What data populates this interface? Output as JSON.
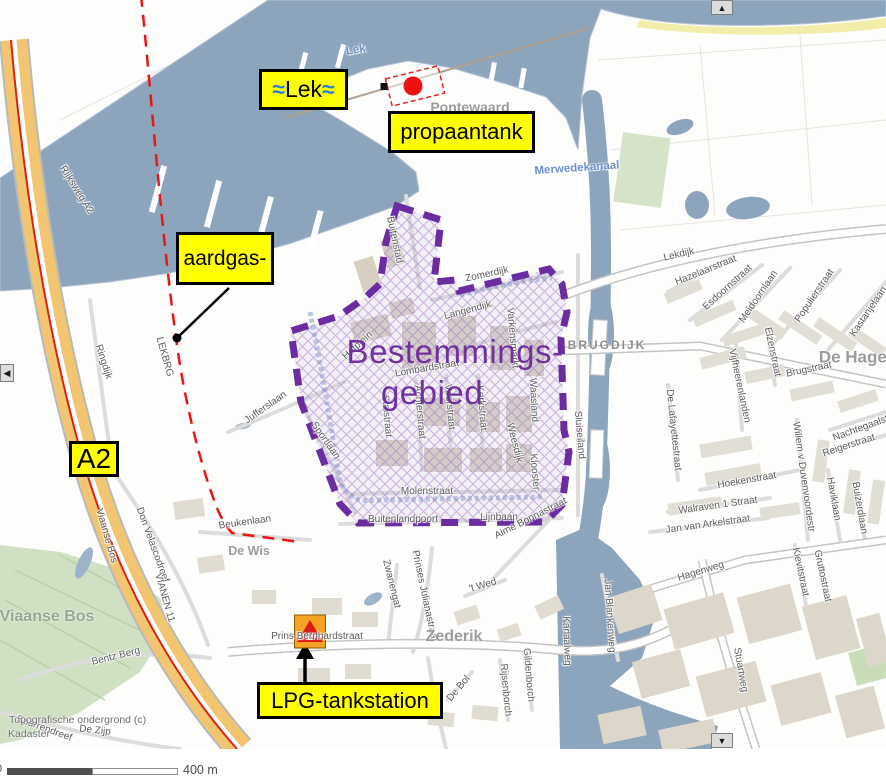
{
  "callouts": {
    "lek_wave": "≈",
    "lek_text": "Lek",
    "propaantank": "propaantank",
    "aardgas": "aardgas-",
    "a2": "A2",
    "lpg": "LPG-tankstation"
  },
  "boundary": {
    "line1": "Bestemmings-",
    "line2": "gebied"
  },
  "scalebar": {
    "zero": "0",
    "label": "400 m"
  },
  "copyright": {
    "line1": "Topografische ondergrond (c)",
    "line2": "Kadaster"
  },
  "controls": {
    "up": "▲",
    "down": "▼",
    "left": "◀"
  },
  "colors": {
    "water": "#8da4bd",
    "highway": "#f2c571",
    "boundary": "#6a2ca0",
    "boundary_text": "#7030a0",
    "callout_bg": "#ffff00",
    "pipeline_red": "#ea1515",
    "green": "#cfe0c3",
    "building": "#ddd8cb",
    "lpg_icon_orange": "#f6a224"
  },
  "map_labels": {
    "water": [
      {
        "text": "Lek",
        "x": 356,
        "y": 51,
        "rot": -10,
        "cls": "water-lbl"
      },
      {
        "text": "Merwedekanaal",
        "x": 577,
        "y": 169,
        "rot": -4,
        "cls": "water-lbl"
      }
    ],
    "places": [
      {
        "text": "Pontewaard",
        "x": 470,
        "y": 107,
        "rot": 0,
        "cls": "place"
      },
      {
        "text": "Middelwaard",
        "x": 230,
        "y": 276,
        "rot": 0,
        "cls": "place"
      },
      {
        "text": "De Wis",
        "x": 249,
        "y": 551,
        "rot": 0,
        "cls": "place",
        "size": 12.5
      },
      {
        "text": "Viaanse Bos",
        "x": 47,
        "y": 617,
        "rot": 0,
        "cls": "place-green"
      },
      {
        "text": "Zederik",
        "x": 454,
        "y": 637,
        "rot": 0,
        "cls": "place",
        "size": 16
      },
      {
        "text": "De Hagen",
        "x": 858,
        "y": 357,
        "rot": 0,
        "cls": "place",
        "size": 17
      },
      {
        "text": "BRUGDIJK",
        "x": 607,
        "y": 345,
        "rot": 0,
        "cls": "place-caps"
      }
    ],
    "streets": [
      {
        "text": "Rijksweg A2",
        "x": 76,
        "y": 190,
        "rot": 58
      },
      {
        "text": "LEKBRG",
        "x": 164,
        "y": 357,
        "rot": 74
      },
      {
        "text": "Ringdijk",
        "x": 103,
        "y": 362,
        "rot": 72
      },
      {
        "text": "Viaanse Bos",
        "x": 106,
        "y": 536,
        "rot": 74
      },
      {
        "text": "Don Velascodreef",
        "x": 152,
        "y": 545,
        "rot": 70
      },
      {
        "text": "VIANEN 11",
        "x": 164,
        "y": 598,
        "rot": 74
      },
      {
        "text": "Bentz Berg",
        "x": 116,
        "y": 657,
        "rot": -14
      },
      {
        "text": "Sparrendreef",
        "x": 44,
        "y": 729,
        "rot": 20
      },
      {
        "text": "De Zijp",
        "x": 95,
        "y": 731,
        "rot": 6
      },
      {
        "text": "Beukenlaan",
        "x": 245,
        "y": 523,
        "rot": -8
      },
      {
        "text": "Jufferslaan",
        "x": 266,
        "y": 408,
        "rot": -35
      },
      {
        "text": "Buitenstad",
        "x": 394,
        "y": 240,
        "rot": 78
      },
      {
        "text": "Zomerdijk",
        "x": 487,
        "y": 275,
        "rot": -12
      },
      {
        "text": "Langendijk",
        "x": 468,
        "y": 311,
        "rot": -15
      },
      {
        "text": "Lombardstraat",
        "x": 427,
        "y": 369,
        "rot": -10
      },
      {
        "text": "Hofplein",
        "x": 358,
        "y": 346,
        "rot": -42
      },
      {
        "text": "Varkensmarkt",
        "x": 512,
        "y": 338,
        "rot": 85
      },
      {
        "text": "Stalstraat",
        "x": 386,
        "y": 416,
        "rot": 85
      },
      {
        "text": "Achterstraat",
        "x": 419,
        "y": 412,
        "rot": 85
      },
      {
        "text": "Voorstraat",
        "x": 449,
        "y": 407,
        "rot": 85
      },
      {
        "text": "Kerkstraat",
        "x": 481,
        "y": 408,
        "rot": 85
      },
      {
        "text": "Waasland",
        "x": 533,
        "y": 400,
        "rot": 87
      },
      {
        "text": "Weesdijk",
        "x": 514,
        "y": 443,
        "rot": 76
      },
      {
        "text": "Klooster",
        "x": 534,
        "y": 472,
        "rot": 85
      },
      {
        "text": "Molenstraat",
        "x": 427,
        "y": 492,
        "rot": 0
      },
      {
        "text": "Buitenlandpoort",
        "x": 403,
        "y": 520,
        "rot": 0
      },
      {
        "text": "Lijnbaan",
        "x": 499,
        "y": 518,
        "rot": 0
      },
      {
        "text": "Sportlaan",
        "x": 325,
        "y": 441,
        "rot": 55
      },
      {
        "text": "Sluiseiland",
        "x": 579,
        "y": 435,
        "rot": 85
      },
      {
        "text": "Prins Bernhardstraat",
        "x": 317,
        "y": 637,
        "rot": 0
      },
      {
        "text": "Zwanengat",
        "x": 391,
        "y": 584,
        "rot": 76
      },
      {
        "text": "Prinses Julianastraat",
        "x": 424,
        "y": 596,
        "rot": 78
      },
      {
        "text": "'t Wed",
        "x": 483,
        "y": 586,
        "rot": -16
      },
      {
        "text": "Aime Bonnastraat",
        "x": 531,
        "y": 519,
        "rot": -27
      },
      {
        "text": "Hofweg",
        "x": 432,
        "y": 700,
        "rot": 82
      },
      {
        "text": "De Bol",
        "x": 459,
        "y": 689,
        "rot": -50
      },
      {
        "text": "Rijsenborch",
        "x": 505,
        "y": 690,
        "rot": 85
      },
      {
        "text": "Gildenborch",
        "x": 528,
        "y": 675,
        "rot": 85
      },
      {
        "text": "Kanaalweg",
        "x": 566,
        "y": 641,
        "rot": 88
      },
      {
        "text": "Jan Blankenweg",
        "x": 609,
        "y": 616,
        "rot": 86
      },
      {
        "text": "Hagenweg",
        "x": 701,
        "y": 572,
        "rot": -17
      },
      {
        "text": "Stuartweg",
        "x": 740,
        "y": 670,
        "rot": 80
      },
      {
        "text": "Lekdijk",
        "x": 679,
        "y": 255,
        "rot": -13
      },
      {
        "text": "Hazelaarstraat",
        "x": 706,
        "y": 271,
        "rot": -22
      },
      {
        "text": "Esdoornstraat",
        "x": 728,
        "y": 288,
        "rot": -42
      },
      {
        "text": "Meidoornlaan",
        "x": 759,
        "y": 297,
        "rot": -56
      },
      {
        "text": "Populierstraat",
        "x": 815,
        "y": 296,
        "rot": -56
      },
      {
        "text": "Kastanjelaan",
        "x": 869,
        "y": 312,
        "rot": -56
      },
      {
        "text": "Elzenstraat",
        "x": 772,
        "y": 352,
        "rot": 78
      },
      {
        "text": "Brugstraat",
        "x": 809,
        "y": 370,
        "rot": -12
      },
      {
        "text": "Vijfheerenlanden",
        "x": 739,
        "y": 386,
        "rot": 78
      },
      {
        "text": "De Lafayettestraat",
        "x": 673,
        "y": 430,
        "rot": 84
      },
      {
        "text": "Hoekenstraat",
        "x": 747,
        "y": 481,
        "rot": -10
      },
      {
        "text": "Walraven 1 Straat",
        "x": 718,
        "y": 506,
        "rot": -8
      },
      {
        "text": "Jan van Arkelstraat",
        "x": 708,
        "y": 525,
        "rot": -8
      },
      {
        "text": "Willem v Duvenvoordestr",
        "x": 803,
        "y": 477,
        "rot": 82
      },
      {
        "text": "Nachtegaalstraat",
        "x": 869,
        "y": 426,
        "rot": -20
      },
      {
        "text": "Reigerstraat",
        "x": 849,
        "y": 446,
        "rot": -18
      },
      {
        "text": "Haviklaan",
        "x": 833,
        "y": 499,
        "rot": 80
      },
      {
        "text": "Buizerdlaan",
        "x": 859,
        "y": 508,
        "rot": 80
      },
      {
        "text": "Kievitstraat",
        "x": 800,
        "y": 572,
        "rot": 78
      },
      {
        "text": "Gruttostraat",
        "x": 822,
        "y": 576,
        "rot": 78
      }
    ]
  }
}
